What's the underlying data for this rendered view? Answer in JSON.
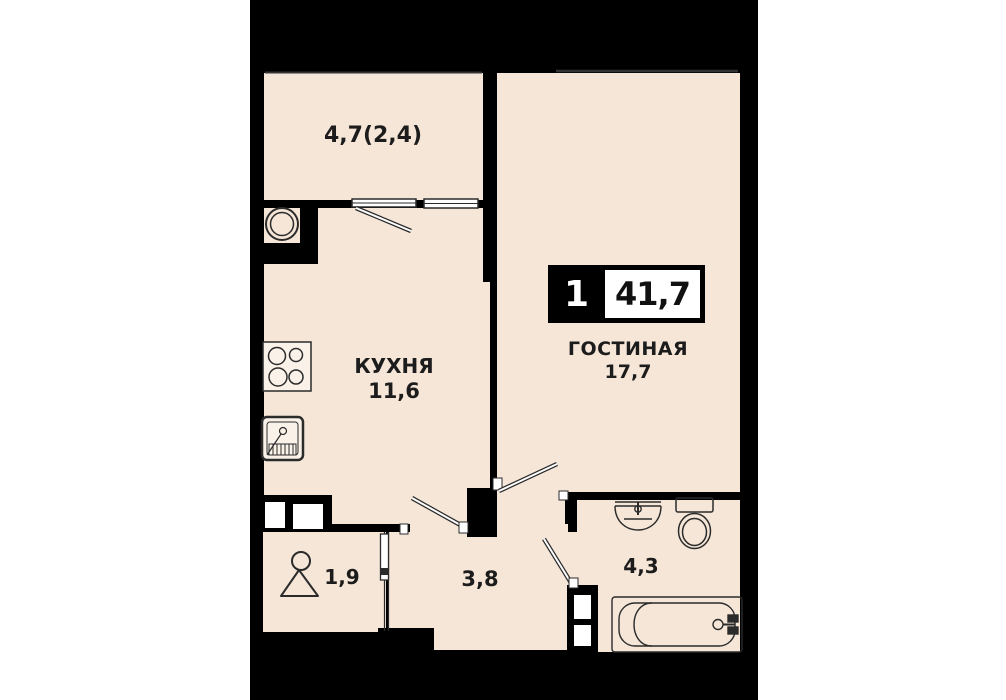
{
  "plan": {
    "type": "apartment-floor-plan",
    "badge": {
      "room_count": "1",
      "total_area": "41,7"
    },
    "rooms": [
      {
        "key": "balcony",
        "name": "",
        "area": "4,7(2,4)"
      },
      {
        "key": "kitchen",
        "name": "КУХНЯ",
        "area": "11,6"
      },
      {
        "key": "living",
        "name": "ГОСТИНАЯ",
        "area": "17,7"
      },
      {
        "key": "hallway",
        "name": "",
        "area": "3,8"
      },
      {
        "key": "wardrobe",
        "name": "",
        "area": "1,9"
      },
      {
        "key": "bathroom",
        "name": "",
        "area": "4,3"
      }
    ],
    "colors": {
      "background": "#ffffff",
      "panel": "#000000",
      "floor": "#f5e6d8",
      "line": "#2b2b2b",
      "badge_text": "#ffffff"
    },
    "icons": [
      "vent-shaft-icon",
      "stove-icon",
      "kitchen-sink-icon",
      "hanger-icon",
      "washbasin-icon",
      "toilet-icon",
      "bathtub-icon",
      "duct-riser-icon",
      "door-swing-icon",
      "window-icon"
    ]
  }
}
